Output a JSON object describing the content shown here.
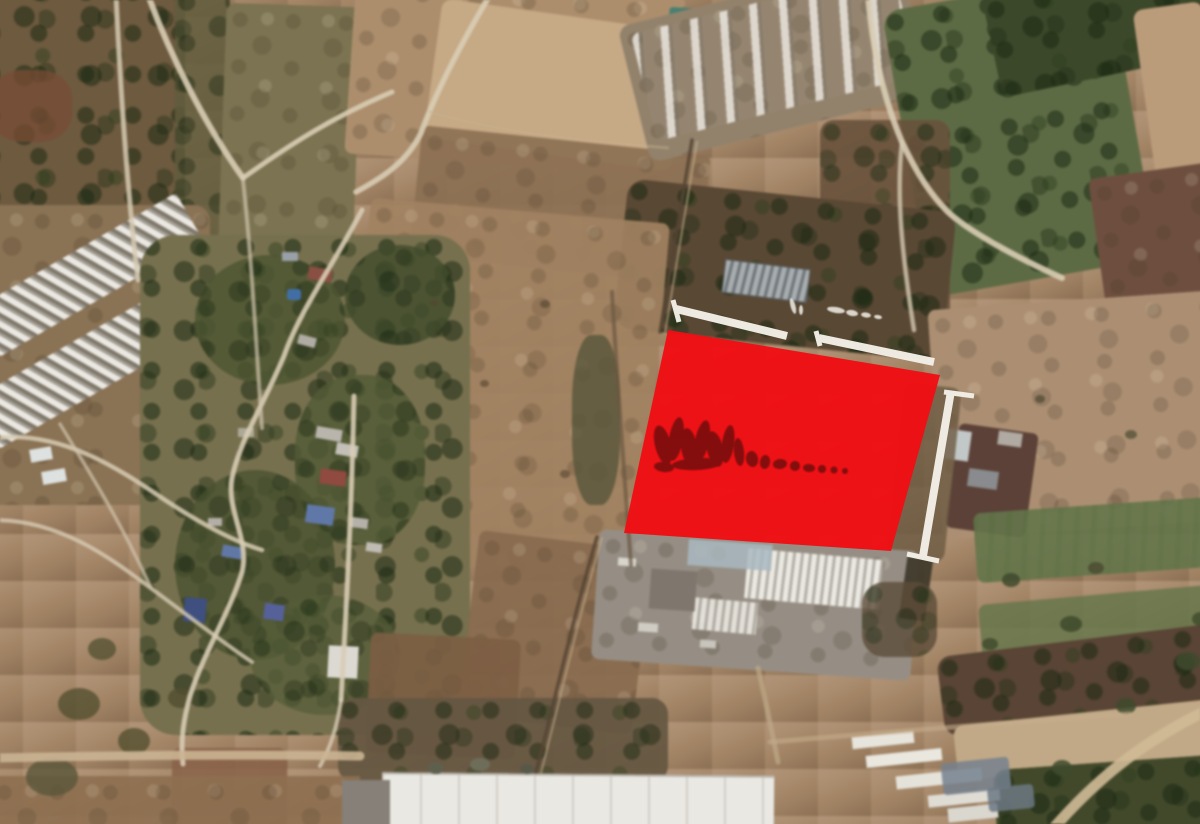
{
  "overlay": {
    "parcel": {
      "fill": "#ef0e14",
      "opacity": 0.97,
      "points": [
        [
          668,
          330
        ],
        [
          940,
          375
        ],
        [
          891,
          551
        ],
        [
          624,
          533
        ]
      ]
    },
    "dimension_lines": {
      "color": "#f3f0e8",
      "main_width": 8,
      "cap_width": 5,
      "segments": [
        [
          676,
          309,
          787,
          336
        ],
        [
          819,
          338,
          934,
          362
        ],
        [
          951,
          391,
          923,
          556
        ]
      ],
      "caps": [
        [
          673,
          300,
          679,
          322
        ],
        [
          816,
          331,
          820,
          346
        ],
        [
          944,
          392,
          974,
          396
        ],
        [
          907,
          554,
          939,
          561
        ]
      ]
    },
    "watermark": {
      "color": "#7a0c10",
      "legible": false
    },
    "tick_color": "#f2efe7"
  }
}
